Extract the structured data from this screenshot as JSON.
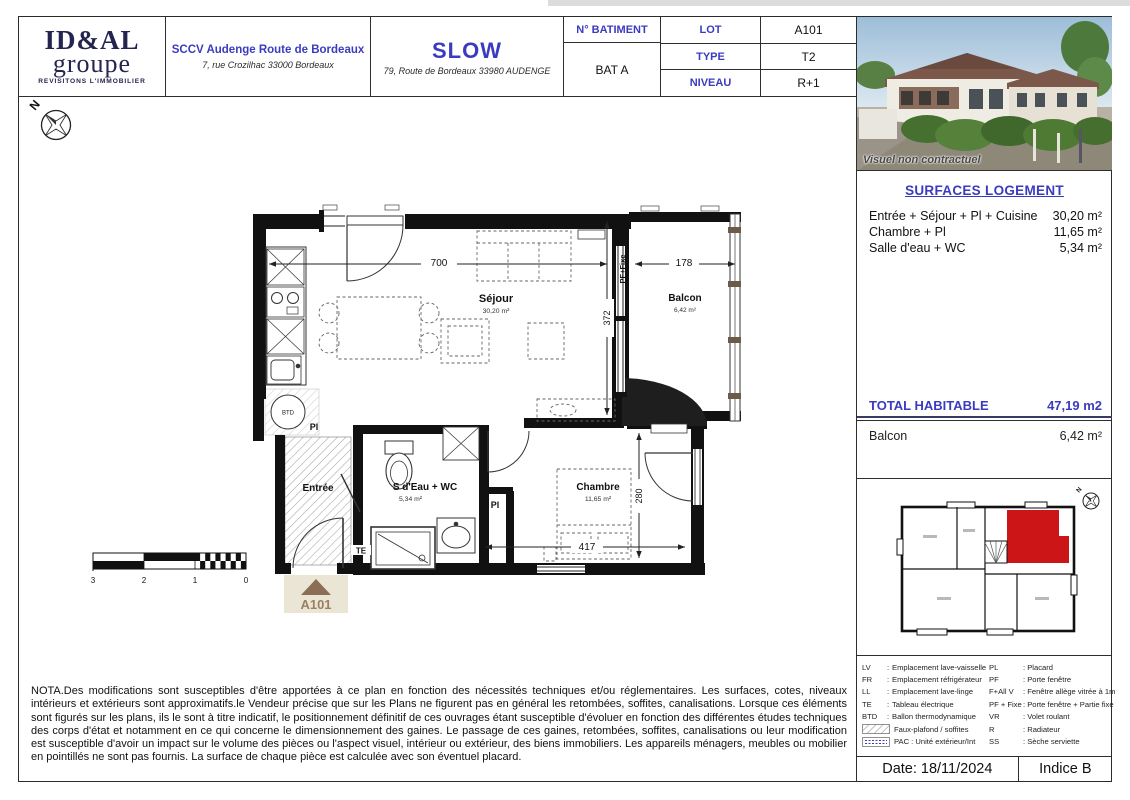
{
  "colors": {
    "accent_blue": "#3b3bbf",
    "logo_navy": "#24244f",
    "unit_red": "#cb1517",
    "marker_brown": "#8a6f55",
    "wall_black": "#111111"
  },
  "header": {
    "logo": {
      "line1": "ID&AL",
      "line2": "groupe",
      "tagline": "REVISITONS L'IMMOBILIER"
    },
    "developer": {
      "name": "SCCV Audenge Route de Bordeaux",
      "address": "7, rue Crozilhac 33000 Bordeaux"
    },
    "project": {
      "name": "SLOW",
      "address": "79, Route de Bordeaux 33980 AUDENGE"
    },
    "info": {
      "batiment_label": "N° BATIMENT",
      "batiment_value": "BAT A",
      "lot_label": "LOT",
      "lot_value": "A101",
      "type_label": "TYPE",
      "type_value": "T2",
      "niveau_label": "NIVEAU",
      "niveau_value": "R+1"
    }
  },
  "visual": {
    "caption": "Visuel non contractuel"
  },
  "surfaces": {
    "title": "SURFACES LOGEMENT",
    "rows": [
      {
        "label": "Entrée + Séjour + Pl + Cuisine",
        "value": "30,20 m²"
      },
      {
        "label": "Chambre + Pl",
        "value": "11,65 m²"
      },
      {
        "label": "Salle d'eau + WC",
        "value": "5,34 m²"
      }
    ],
    "total_label": "TOTAL HABITABLE",
    "total_value": "47,19 m2",
    "balcon_label": "Balcon",
    "balcon_value": "6,42 m²"
  },
  "plan": {
    "rooms": {
      "sejour": {
        "name": "Séjour",
        "area": "30,20 m²"
      },
      "balcon": {
        "name": "Balcon",
        "area": "6,42 m²"
      },
      "entree": {
        "name": "Entrée"
      },
      "sdeau": {
        "name": "S d'Eau + WC",
        "area": "5,34 m²"
      },
      "chambre": {
        "name": "Chambre",
        "area": "11,65 m²"
      }
    },
    "dims": {
      "d700": "700",
      "d178": "178",
      "d372": "372",
      "d280": "280",
      "d417": "417"
    },
    "annotations": {
      "pf_fixe": "PF+Fixe",
      "pl1": "Pl",
      "pl2": "Pl",
      "te": "TE",
      "btd": "BTD",
      "lot": "A101",
      "north": "N"
    },
    "scale_ticks": [
      "3",
      "2",
      "1",
      "0"
    ]
  },
  "legend": {
    "separator": ":",
    "left": [
      {
        "abbr": "LV",
        "text": "Emplacement lave-vaisselle"
      },
      {
        "abbr": "FR",
        "text": "Emplacement réfrigérateur"
      },
      {
        "abbr": "LL",
        "text": "Emplacement lave-linge"
      },
      {
        "abbr": "TE",
        "text": "Tableau électrique"
      },
      {
        "abbr": "BTD",
        "text": "Ballon thermodynamique"
      },
      {
        "text": "Faux-plafond / soffites"
      },
      {
        "text": "PAC : Unité extérieur/Int"
      }
    ],
    "right": [
      {
        "abbr": "PL",
        "text": ": Placard"
      },
      {
        "abbr": "PF",
        "text": ": Porte fenêtre"
      },
      {
        "abbr": "F+All V",
        "text": ": Fenêtre allège vitrée à 1m"
      },
      {
        "abbr": "PF + Fixe",
        "text": ": Porte fenêtre + Partie fixe"
      },
      {
        "abbr": "VR",
        "text": ": Volet roulant"
      },
      {
        "abbr": "R",
        "text": ": Radiateur"
      },
      {
        "abbr": "SS",
        "text": ": Sèche serviette"
      }
    ]
  },
  "footer": {
    "date": "Date: 18/11/2024",
    "indice": "Indice B"
  },
  "nota": {
    "text": "NOTA.Des modifications sont susceptibles d'être apportées à ce plan en fonction des nécessités techniques et/ou réglementaires. Les surfaces, cotes, niveaux intérieurs et extérieurs sont approximatifs.le Vendeur précise que sur les Plans ne figurent pas en général les retombées, soffites, canalisations. Lorsque ces éléments sont figurés sur les plans, ils le sont à titre indicatif, le positionnement définitif de ces ouvrages étant susceptible d'évoluer en fonction des différentes études techniques des corps d'état et notamment en ce qui concerne le dimensionnement des gaines. Le passage de ces gaines, retombées, soffites, canalisations ou leur modification est susceptible d'avoir un impact sur le volume des pièces ou l'aspect visuel, intérieur ou extérieur, des biens immobiliers. Les appareils ménagers, meubles ou mobilier en pointillés ne sont pas fournis. La surface de chaque pièce est calculée avec son éventuel placard."
  }
}
